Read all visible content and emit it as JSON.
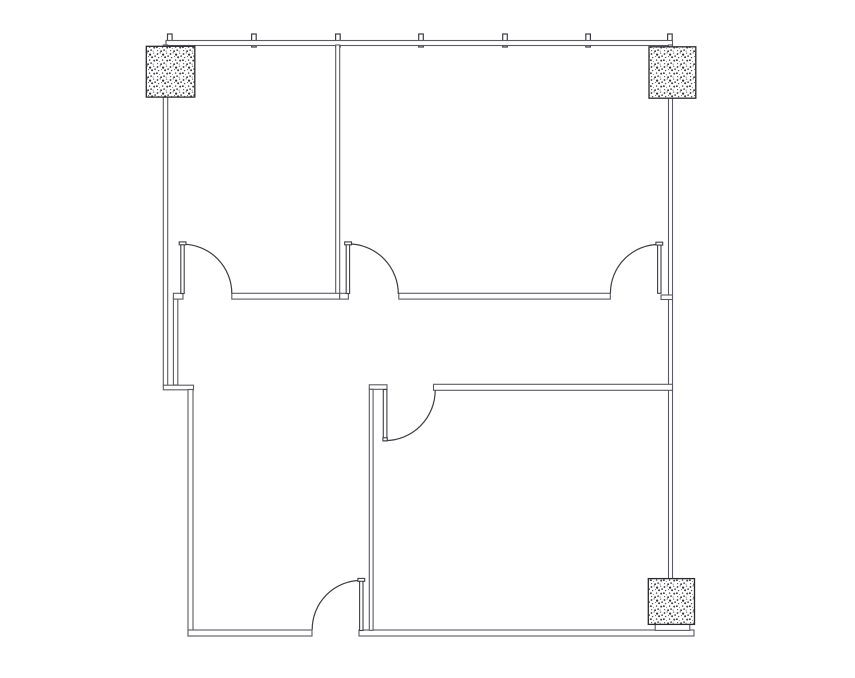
{
  "title": "floor-plan-drawing",
  "canvas": {
    "width": 855,
    "height": 678,
    "background": "#ffffff"
  },
  "colors": {
    "wall_line": "#5a5a61",
    "door_line": "#3e3e44",
    "tick_line": "#3d3d44",
    "column_border": "#2a2a2e",
    "speckle_dark": "#2f2f33",
    "speckle_light": "#74747a",
    "fill": "#ffffff"
  },
  "floorplan": {
    "mullion_ticks": {
      "y": 34,
      "height": 13,
      "width": 4.6,
      "xs": [
        169.8,
        253.9,
        337.9,
        421,
        505,
        588.1,
        669.9
      ]
    },
    "walls": [
      {
        "id": "top-exterior",
        "x": 166,
        "y": 40.5,
        "w": 506.5,
        "h": 5
      },
      {
        "id": "left-exterior-upper",
        "x": 163.3,
        "y": 45,
        "w": 4.4,
        "h": 340.5
      },
      {
        "id": "corridor-west-inner",
        "x": 173.4,
        "y": 297.5,
        "w": 4.4,
        "h": 87.5
      },
      {
        "id": "left-jog",
        "x": 163.3,
        "y": 385.2,
        "w": 30.2,
        "h": 4.6
      },
      {
        "id": "left-exterior-lower",
        "x": 188,
        "y": 389.5,
        "w": 5,
        "h": 246.5
      },
      {
        "id": "bottom-exterior-west",
        "x": 188,
        "y": 630,
        "w": 124,
        "h": 6
      },
      {
        "id": "bottom-exterior-east",
        "x": 359,
        "y": 630,
        "w": 335,
        "h": 6
      },
      {
        "id": "right-exterior",
        "x": 668.5,
        "y": 45,
        "w": 4,
        "h": 534
      },
      {
        "id": "partition-top-rooms",
        "x": 335.7,
        "y": 45,
        "w": 4,
        "h": 253.8
      },
      {
        "id": "corridor-north-stub-west",
        "x": 173.4,
        "y": 293.3,
        "w": 9.6,
        "h": 5.8
      },
      {
        "id": "corridor-north-a",
        "x": 231.8,
        "y": 293.3,
        "w": 107.9,
        "h": 5.8
      },
      {
        "id": "corridor-north-b",
        "x": 339.7,
        "y": 293.3,
        "w": 8.7,
        "h": 5.8
      },
      {
        "id": "corridor-north-c",
        "x": 398.8,
        "y": 293.3,
        "w": 211.5,
        "h": 5.8
      },
      {
        "id": "corridor-north-stub-east",
        "x": 661,
        "y": 295,
        "w": 11.5,
        "h": 4.5
      },
      {
        "id": "room-se-north",
        "x": 433.5,
        "y": 384.3,
        "w": 239,
        "h": 6
      },
      {
        "id": "door4-hinge-cap",
        "x": 369.3,
        "y": 384.8,
        "w": 17.7,
        "h": 4.5
      },
      {
        "id": "partition-bottom-rooms",
        "x": 369.3,
        "y": 389.3,
        "w": 3.8,
        "h": 241
      },
      {
        "id": "column-base-sliver",
        "x": 655.2,
        "y": 624.2,
        "w": 34.6,
        "h": 6.2
      }
    ],
    "doors": [
      {
        "id": "1",
        "leaf": {
          "x": 180.8,
          "y": 243.6,
          "w": 3.4,
          "h": 49.9
        },
        "cap": {
          "x": 179.2,
          "y": 241.9,
          "w": 6.8,
          "h": 2.9
        },
        "arc": "M 182.5 244.2 A 49.3 49.3 0 0 1 231.8 293.5"
      },
      {
        "id": "2",
        "leaf": {
          "x": 346.2,
          "y": 243.6,
          "w": 3.4,
          "h": 49.9
        },
        "cap": {
          "x": 344.7,
          "y": 241.9,
          "w": 6.8,
          "h": 2.9
        },
        "arc": "M 348.3 243.9 A 50 50 0 0 1 398.3 293.9"
      },
      {
        "id": "3",
        "leaf": {
          "x": 657.6,
          "y": 244,
          "w": 3.4,
          "h": 49.3
        },
        "cap": {
          "x": 655.9,
          "y": 242.2,
          "w": 6.8,
          "h": 2.9
        },
        "arc": "M 659.3 244.4 A 48.9 48.9 0 0 0 610.4 293.3"
      },
      {
        "id": "4",
        "leaf": {
          "x": 383.3,
          "y": 389.5,
          "w": 3.6,
          "h": 51.3
        },
        "cap": {
          "x": 382.9,
          "y": 437.8,
          "w": 4.4,
          "h": 3
        },
        "arc": "M 385.1 440.6 A 50.3 50.3 0 0 0 435.2 390.3"
      },
      {
        "id": "5",
        "leaf": {
          "x": 359.6,
          "y": 580,
          "w": 3.4,
          "h": 50.5
        },
        "cap": {
          "x": 357.9,
          "y": 578.4,
          "w": 6.8,
          "h": 2.9
        },
        "arc": "M 361.3 580.4 A 49 49 0 0 0 312.2 629.6"
      }
    ],
    "columns": [
      {
        "id": "northwest",
        "x": 146.3,
        "y": 46.3,
        "w": 48.5,
        "h": 50.8
      },
      {
        "id": "northeast",
        "x": 649,
        "y": 46.8,
        "w": 46.8,
        "h": 51.4
      },
      {
        "id": "southeast",
        "x": 648.3,
        "y": 578.6,
        "w": 46.2,
        "h": 45.8
      }
    ]
  }
}
